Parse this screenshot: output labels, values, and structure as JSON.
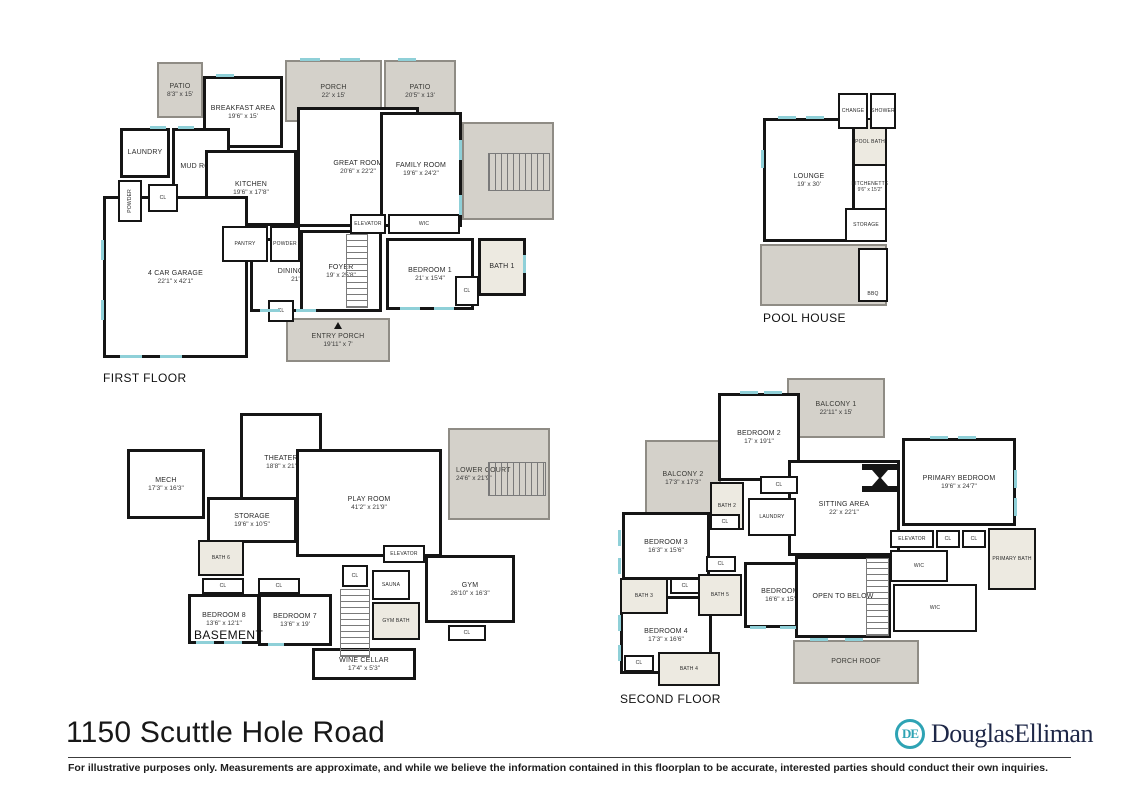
{
  "page": {
    "title": "1150 Scuttle Hole Road",
    "footer_disclaimer": "For illustrative purposes only.  Measurements are approximate, and while we believe the information contained in this floorplan to be accurate, interested parties should conduct their own inquiries.",
    "brand": {
      "wordmark": "DouglasElliman",
      "monogram": "DE"
    }
  },
  "colors": {
    "wall": "#151515",
    "outdoor_fill": "#d4d1ca",
    "bath_fill": "#edeae1",
    "window": "#8fd0d8",
    "brand_teal": "#2ea3b4",
    "brand_navy": "#1e2747"
  },
  "floors": {
    "first": {
      "label": "FIRST FLOOR",
      "rooms": [
        {
          "name": "PATIO",
          "dims": "8'3\" x 15'"
        },
        {
          "name": "BREAKFAST AREA",
          "dims": "19'6\" x 15'"
        },
        {
          "name": "PORCH",
          "dims": "22' x 15'"
        },
        {
          "name": "PATIO",
          "dims": "20'5\" x 13'"
        },
        {
          "name": "LAUNDRY",
          "dims": ""
        },
        {
          "name": "MUD ROOM",
          "dims": ""
        },
        {
          "name": "POWDER",
          "dims": ""
        },
        {
          "name": "CL",
          "dims": ""
        },
        {
          "name": "KITCHEN",
          "dims": "19'6\" x 17'8\""
        },
        {
          "name": "GREAT ROOM",
          "dims": "20'6\" x 22'2\""
        },
        {
          "name": "FAMILY ROOM",
          "dims": "19'6\" x 24'2\""
        },
        {
          "name": "PANTRY",
          "dims": ""
        },
        {
          "name": "POWDER",
          "dims": ""
        },
        {
          "name": "4 CAR GARAGE",
          "dims": "22'1\" x 42'1\""
        },
        {
          "name": "DINING ROOM",
          "dims": "21' x 14'"
        },
        {
          "name": "FOYER",
          "dims": "19' x 25'8\""
        },
        {
          "name": "ELEVATOR",
          "dims": ""
        },
        {
          "name": "WIC",
          "dims": ""
        },
        {
          "name": "BEDROOM 1",
          "dims": "21' x 15'4\""
        },
        {
          "name": "BATH 1",
          "dims": ""
        },
        {
          "name": "CL",
          "dims": ""
        },
        {
          "name": "CL",
          "dims": ""
        },
        {
          "name": "ENTRY PORCH",
          "dims": "19'11\" x 7'"
        }
      ]
    },
    "pool_house": {
      "label": "POOL HOUSE",
      "rooms": [
        {
          "name": "CHANGE",
          "dims": ""
        },
        {
          "name": "SHOWER",
          "dims": ""
        },
        {
          "name": "POOL BATH",
          "dims": ""
        },
        {
          "name": "LOUNGE",
          "dims": "19' x 30'"
        },
        {
          "name": "KITCHENETTE",
          "dims": "9'6\" x 15'2\""
        },
        {
          "name": "STORAGE",
          "dims": ""
        },
        {
          "name": "BBQ",
          "dims": ""
        }
      ]
    },
    "basement": {
      "label": "BASEMENT",
      "rooms": [
        {
          "name": "MECH",
          "dims": "17'3\" x 16'3\""
        },
        {
          "name": "THEATER",
          "dims": "18'8\" x 21'"
        },
        {
          "name": "STORAGE",
          "dims": "19'6\" x 10'5\""
        },
        {
          "name": "PLAY ROOM",
          "dims": "41'2\" x 21'9\""
        },
        {
          "name": "LOWER COURT",
          "dims": "24'6\" x 21'9\""
        },
        {
          "name": "BATH 6",
          "dims": ""
        },
        {
          "name": "CL",
          "dims": ""
        },
        {
          "name": "CL",
          "dims": ""
        },
        {
          "name": "BEDROOM 8",
          "dims": "13'6\" x 12'1\""
        },
        {
          "name": "BEDROOM 7",
          "dims": "13'6\" x 19'"
        },
        {
          "name": "ELEVATOR",
          "dims": ""
        },
        {
          "name": "CL",
          "dims": ""
        },
        {
          "name": "SAUNA",
          "dims": ""
        },
        {
          "name": "GYM BATH",
          "dims": ""
        },
        {
          "name": "GYM",
          "dims": "26'10\" x 16'3\""
        },
        {
          "name": "CL",
          "dims": ""
        },
        {
          "name": "WINE CELLAR",
          "dims": "17'4\" x 5'3\""
        }
      ]
    },
    "second": {
      "label": "SECOND FLOOR",
      "rooms": [
        {
          "name": "BALCONY 1",
          "dims": "22'11\" x 15'"
        },
        {
          "name": "BEDROOM 2",
          "dims": "17' x 19'1\""
        },
        {
          "name": "BALCONY 2",
          "dims": "17'3\" x 17'3\""
        },
        {
          "name": "BATH 2",
          "dims": ""
        },
        {
          "name": "CL",
          "dims": ""
        },
        {
          "name": "LAUNDRY",
          "dims": ""
        },
        {
          "name": "CL",
          "dims": ""
        },
        {
          "name": "SITTING AREA",
          "dims": "22' x 22'1\""
        },
        {
          "name": "PRIMARY BEDROOM",
          "dims": "19'6\" x 24'7\""
        },
        {
          "name": "BEDROOM 3",
          "dims": "16'3\" x 15'6\""
        },
        {
          "name": "BATH 3",
          "dims": ""
        },
        {
          "name": "CL",
          "dims": ""
        },
        {
          "name": "BEDROOM 4",
          "dims": "17'3\" x 16'6\""
        },
        {
          "name": "CL",
          "dims": ""
        },
        {
          "name": "BATH 4",
          "dims": ""
        },
        {
          "name": "CL",
          "dims": ""
        },
        {
          "name": "BATH 5",
          "dims": ""
        },
        {
          "name": "BEDROOM 5",
          "dims": "16'6\" x 15'2\""
        },
        {
          "name": "OPEN TO BELOW",
          "dims": ""
        },
        {
          "name": "PORCH ROOF",
          "dims": ""
        },
        {
          "name": "ELEVATOR",
          "dims": ""
        },
        {
          "name": "CL",
          "dims": ""
        },
        {
          "name": "CL",
          "dims": ""
        },
        {
          "name": "WIC",
          "dims": ""
        },
        {
          "name": "WIC",
          "dims": ""
        },
        {
          "name": "PRIMARY BATH",
          "dims": ""
        }
      ]
    }
  }
}
